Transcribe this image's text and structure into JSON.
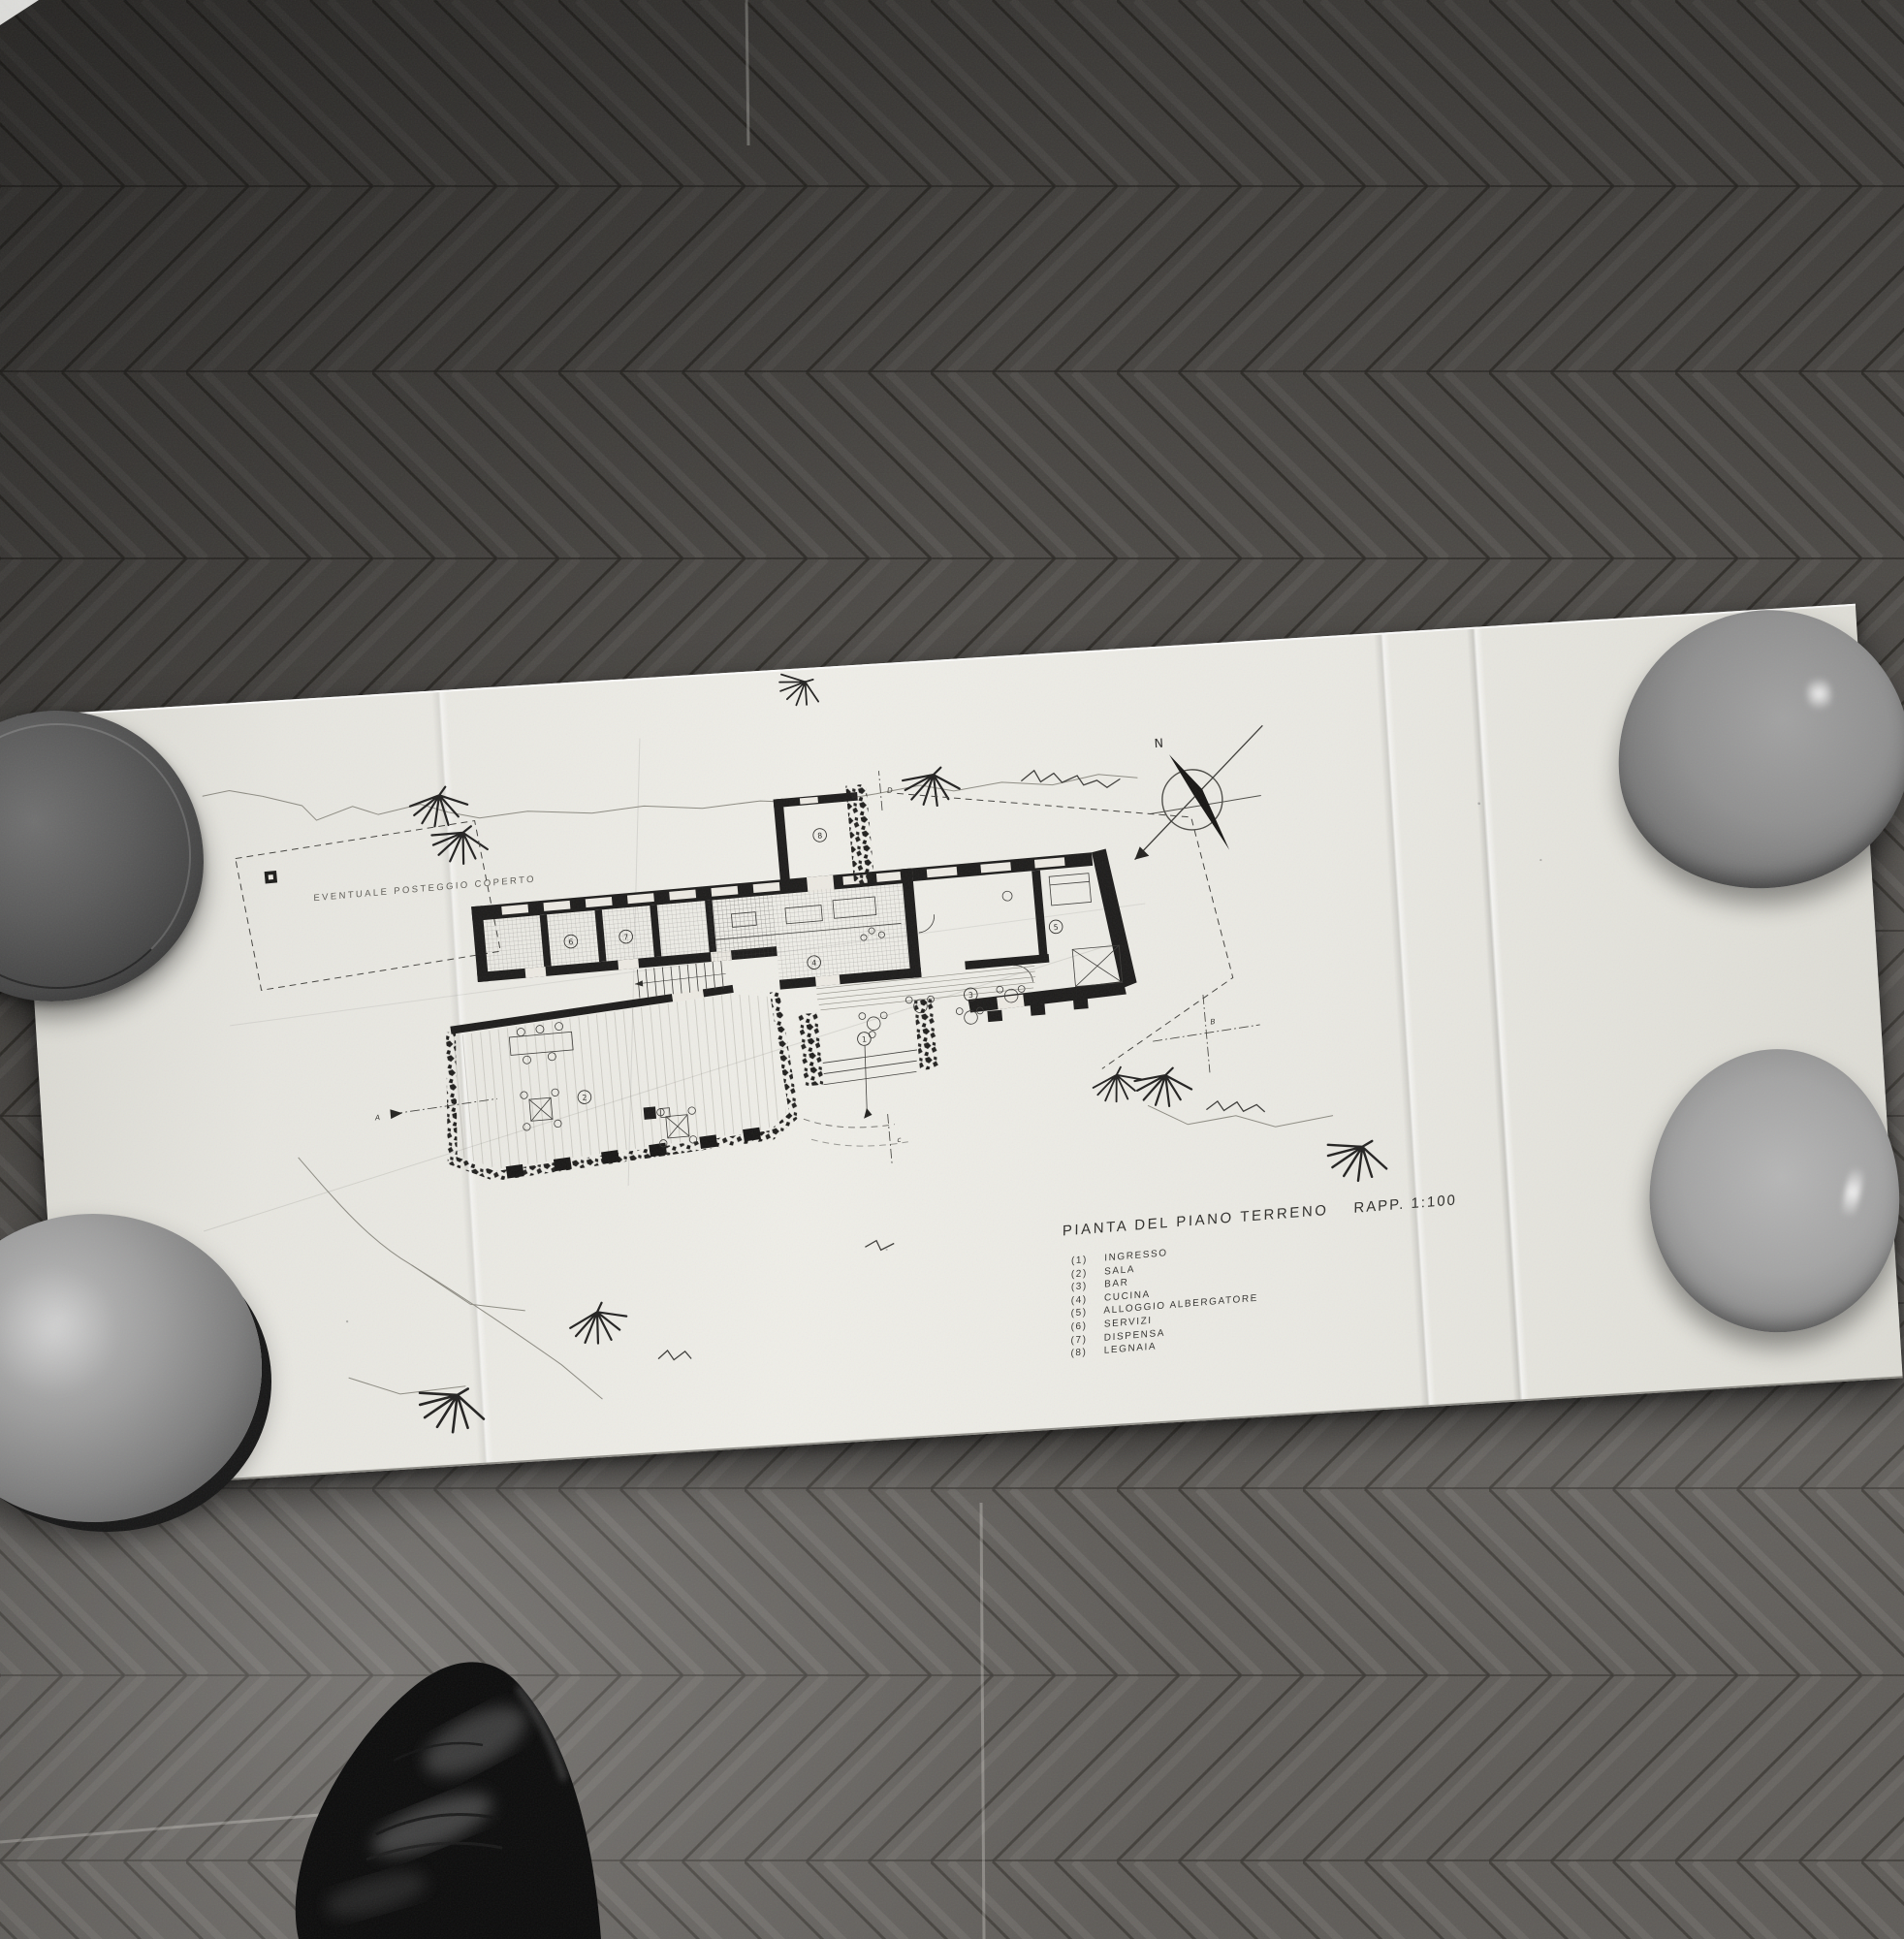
{
  "scene": {
    "medium": "black-and-white photograph",
    "subject": "unfolded architectural drawing lying on herringbone parquet floor, weighted by four ceramic bowls, photographer's shoe tip at bottom",
    "palette": {
      "floor_dark": "#393734",
      "floor_mid": "#55524f",
      "paper": "#ebeae4",
      "ink": "#222120",
      "bowl_gray": "#8f8f8f",
      "shoe_black": "#0c0c0c"
    }
  },
  "drawing": {
    "title": "PIANTA DEL PIANO TERRENO",
    "scale_label": "RAPP. 1:100",
    "note_parking": "EVENTUALE POSTEGGIO COPERTO",
    "compass_north": "N",
    "rooms": [
      {
        "num": "1",
        "name": "INGRESSO"
      },
      {
        "num": "2",
        "name": "SALA"
      },
      {
        "num": "3",
        "name": "BAR"
      },
      {
        "num": "4",
        "name": "CUCINA"
      },
      {
        "num": "5",
        "name": "ALLOGGIO ALBERGATORE"
      },
      {
        "num": "6",
        "name": "SERVIZI"
      },
      {
        "num": "7",
        "name": "DISPENSA"
      },
      {
        "num": "8",
        "name": "LEGNAIA"
      }
    ],
    "section_markers": {
      "a": "A",
      "b": "B",
      "c": "c",
      "d": "D"
    }
  }
}
